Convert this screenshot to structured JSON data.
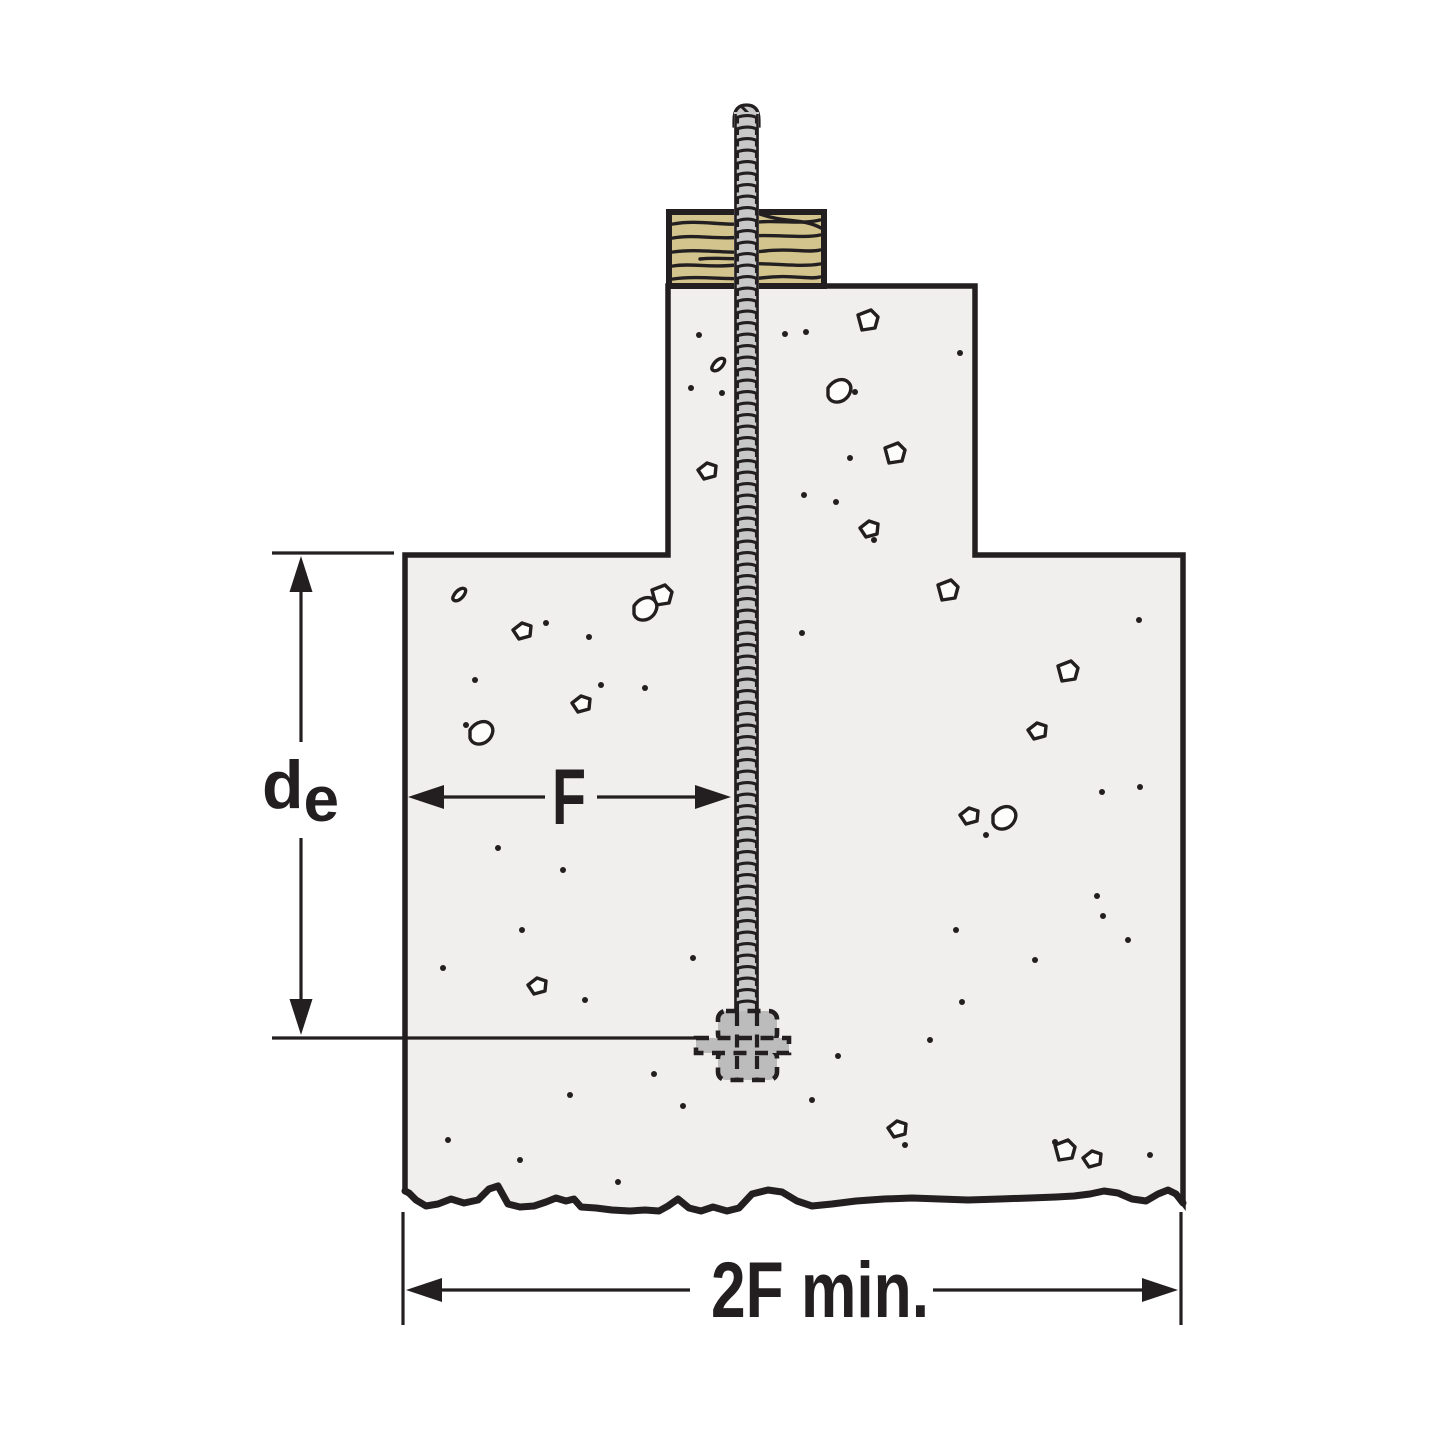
{
  "diagram": {
    "description": "Anchor bolt embedded in concrete stem wall and footing with wood sill plate",
    "labels": {
      "embedment_depth_main": "d",
      "embedment_depth_sub": "e",
      "edge_distance": "F",
      "min_footing_width": "2F min."
    },
    "colors": {
      "outline": "#231f20",
      "concrete": "#f0efed",
      "wood": "#d2c48c",
      "rod": "#c8c8c8",
      "hardware": "#bcbcbc",
      "speckle_fill": "#fdfdfc",
      "background": "#ffffff"
    }
  }
}
